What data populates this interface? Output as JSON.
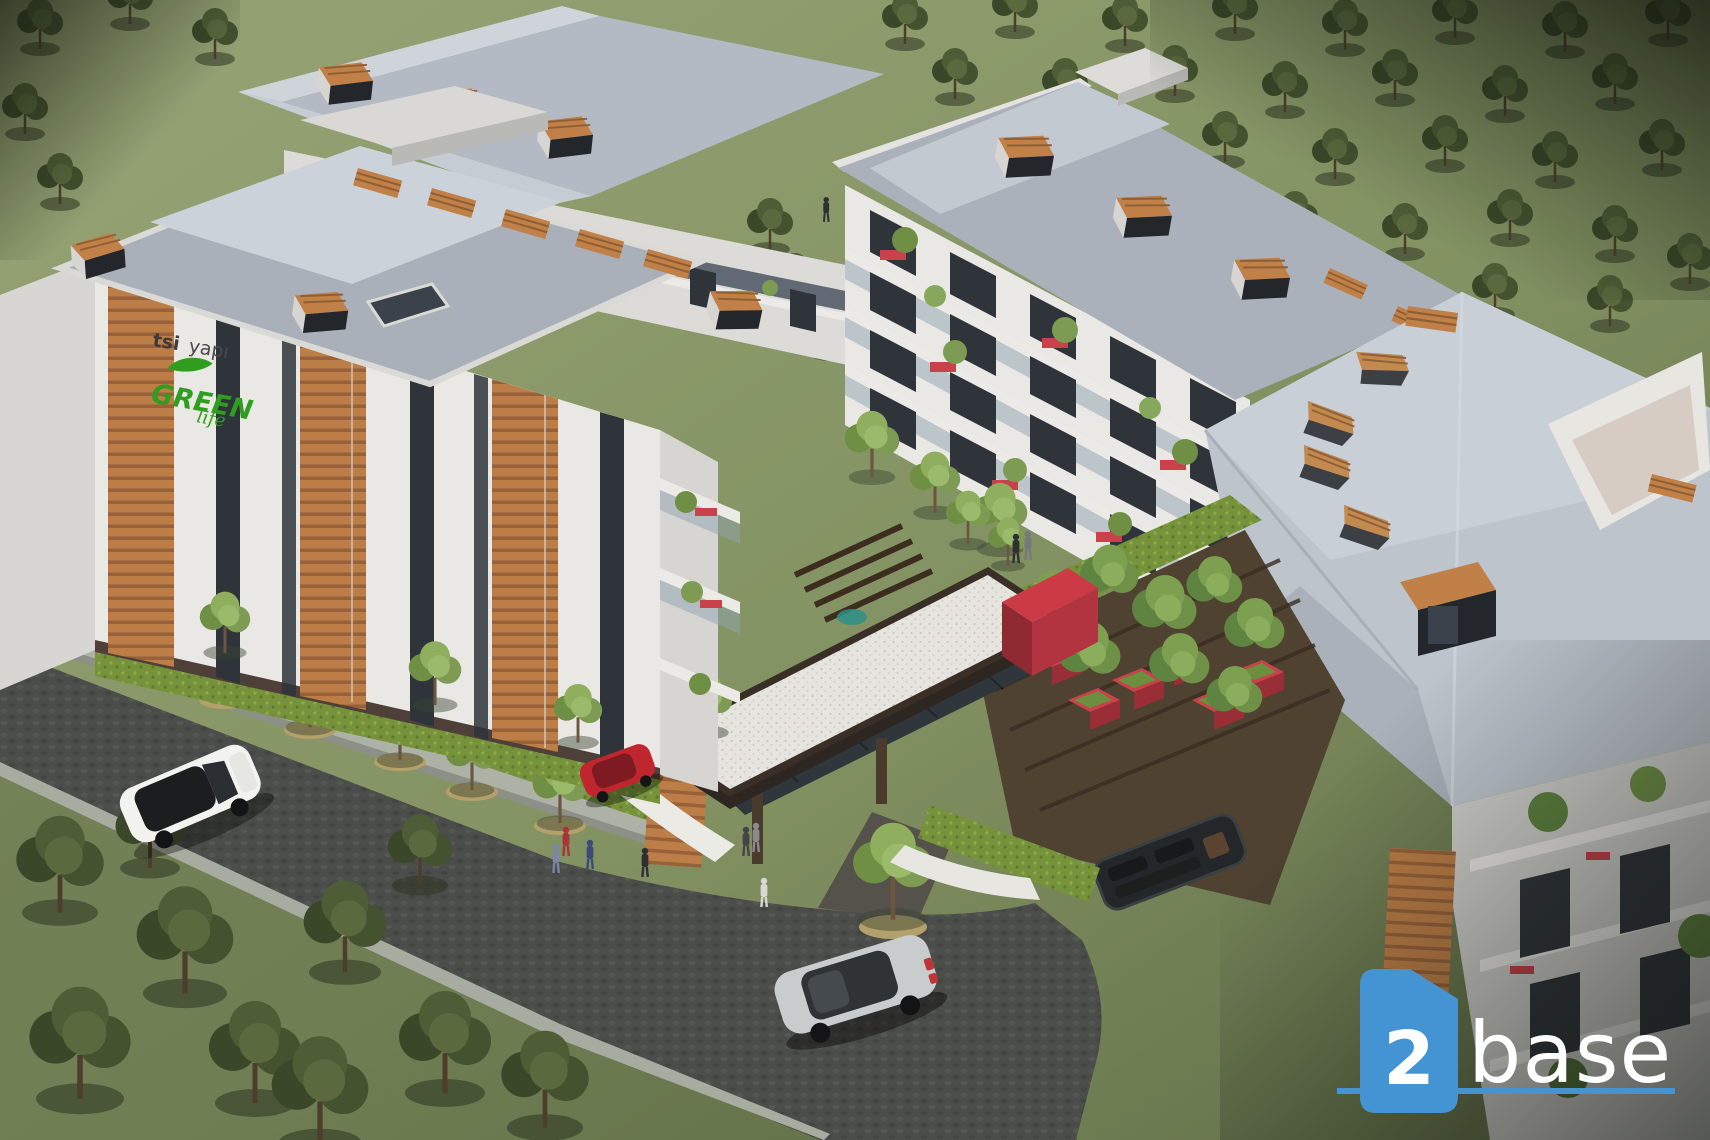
{
  "scene": {
    "kind": "aerial architectural rendering",
    "subject": "residential apartment complex with gardens, entrance canopy and roads"
  },
  "signage": {
    "developer_bold": "tsi",
    "developer_light": "yapı",
    "project_name": "GREEN",
    "project_script": "life",
    "logo_green": "#2f9e1f",
    "text_dark": "#3b3b3d"
  },
  "watermark": {
    "number": "2",
    "name": "base",
    "accent_color": "#4494d4",
    "text_color": "#ffffff"
  },
  "palette": {
    "roof": "#b3bac4",
    "roof_light": "#cdd3da",
    "wall": "#e9e8e4",
    "wood": "#bc7d46",
    "red_accent": "#cc3b45",
    "glass": "#2f343b",
    "road": "#4b4d4a",
    "sidewalk": "#adb1a6",
    "hedge": "#76933c",
    "grass_light": "#93a171",
    "grass_dark": "#5a6742",
    "tree_dark": "#3f5231",
    "gravel": "#e6e4de"
  }
}
